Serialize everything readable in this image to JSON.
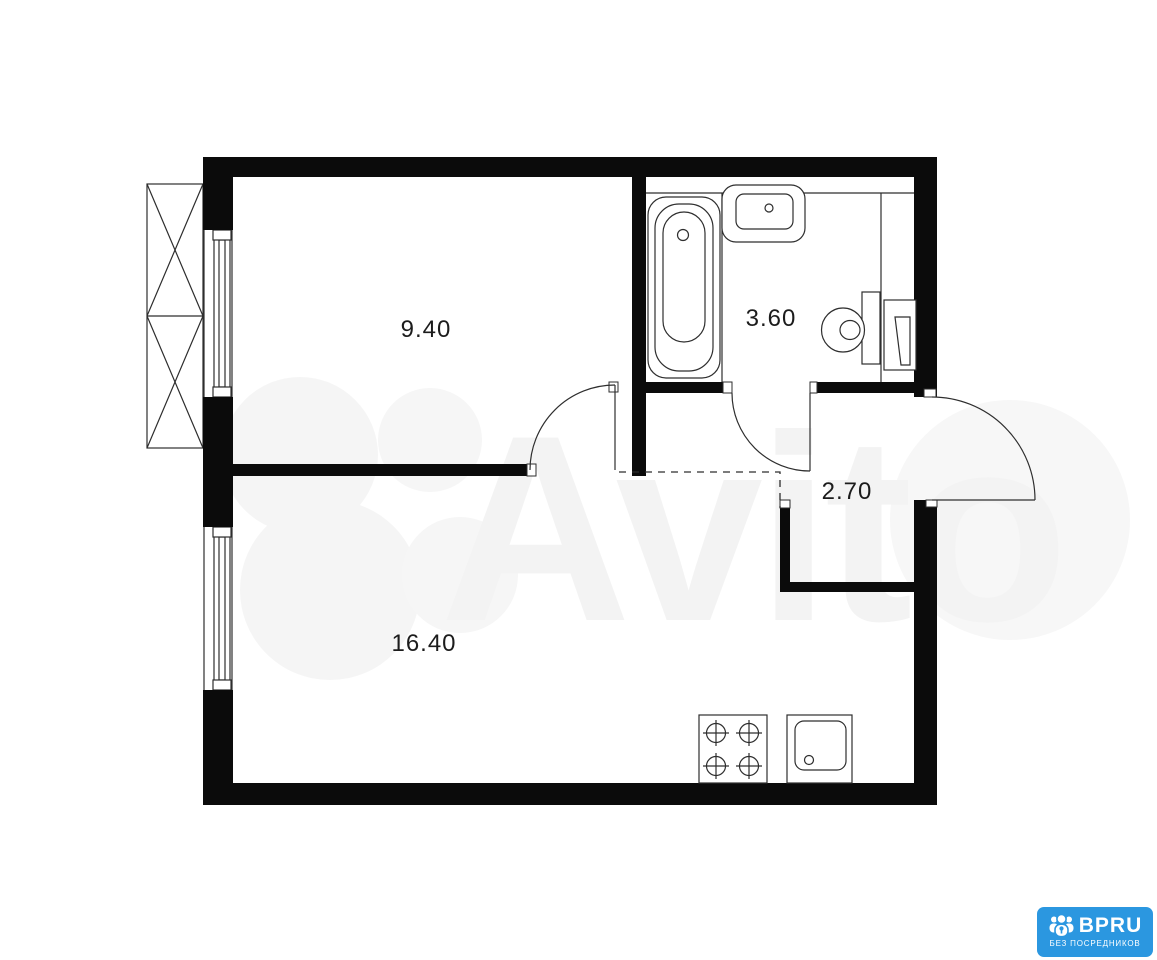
{
  "canvas": {
    "background": "#ffffff",
    "wall_color": "#0b0b0b",
    "line_color": "#2e2e2e"
  },
  "watermark": {
    "text": "Avito",
    "color": "#f3f3f3",
    "icon": "avito-circles-logo"
  },
  "floor_plan": {
    "type": "apartment-floor-plan",
    "rooms": [
      {
        "id": "bedroom",
        "area": "9.40"
      },
      {
        "id": "bathroom",
        "area": "3.60"
      },
      {
        "id": "hallway",
        "area": "2.70"
      },
      {
        "id": "living-room-kitchen",
        "area": "16.40"
      }
    ],
    "fixtures": [
      "balcony-crossed",
      "window",
      "bathtub",
      "wash-basin",
      "toilet",
      "water-heater",
      "stove-4-burner",
      "kitchen-sink",
      "interior-door",
      "entrance-door",
      "open-boundary-dashed"
    ]
  },
  "badge": {
    "brand": "BPRU",
    "tagline": "БЕЗ ПОСРЕДНИКОВ",
    "background": "#2b97e0",
    "icon": "people-lock-icon"
  }
}
